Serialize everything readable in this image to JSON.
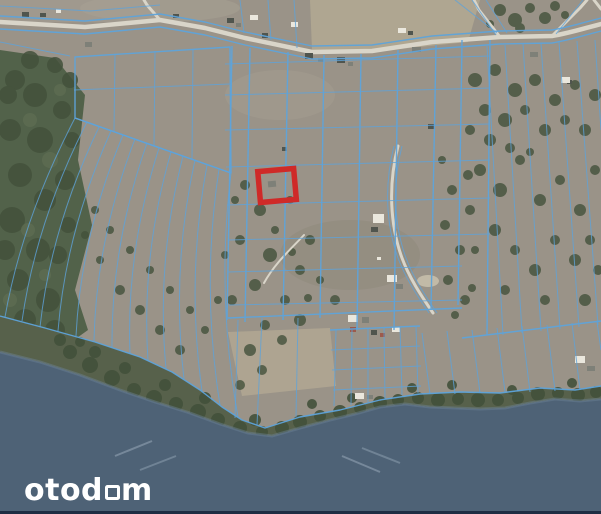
{
  "branding": {
    "logo_text": "otodom",
    "logo_part1": "otod",
    "logo_part2": "m"
  },
  "map": {
    "kind": "aerial-cadastral-map",
    "description": "Satellite view of a lakeside peninsula with blue cadastral parcel boundaries and one parcel highlighted in red",
    "highlighted_parcel": {
      "x": 259,
      "y": 170,
      "width": 36,
      "height": 31,
      "rotation_deg": -5,
      "stroke_width": 5.5
    }
  },
  "colors": {
    "land": "#9a9388",
    "land_light": "#b3a993",
    "land_pale": "#a6a093",
    "land_dark": "#8c8679",
    "sand": "#c6bfab",
    "forest": "#52624a",
    "forest_dark": "#43513b",
    "forest_light": "#5e6d52",
    "shore_veg": "#57614b",
    "water": "#4e6276",
    "water_light": "#6d8296",
    "water_streak": "#8799aa",
    "road": "#d9d5c9",
    "parcel_line": "#5ea3da",
    "highlight_red": "#cf2a28",
    "building_dark": "#50554e",
    "building_gray": "#7e8078",
    "building_white": "#eae7dd",
    "building_red": "#9d5a4c",
    "footer_bar": "#1f2d43",
    "logo": "#ffffff"
  }
}
